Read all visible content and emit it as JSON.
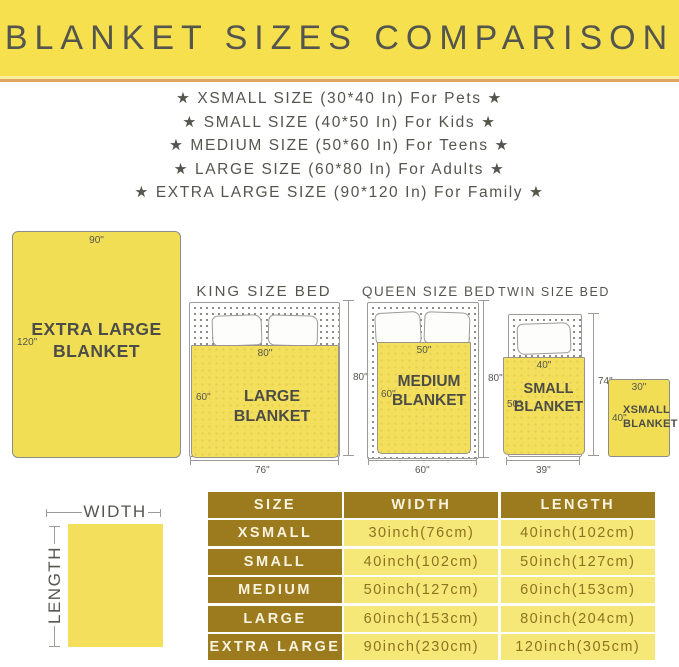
{
  "banner": {
    "title": "BLANKET SIZES COMPARISON"
  },
  "size_list": [
    "★  XSMALL SIZE (30*40 In) For Pets  ★",
    "★  SMALL SIZE (40*50 In) For Kids  ★",
    "★  MEDIUM SIZE (50*60 In) For Teens  ★",
    "★  LARGE SIZE (60*80 In) For Adults  ★",
    "★  EXTRA LARGE SIZE (90*120 In) For Family  ★"
  ],
  "diagram": {
    "xl": {
      "label_line1": "EXTRA LARGE",
      "label_line2": "BLANKET",
      "width_dim": "90\"",
      "length_dim": "120\""
    },
    "king": {
      "title": "KING SIZE BED",
      "blanket_label": "LARGE BLANKET",
      "blanket_width": "80\"",
      "blanket_length": "60\"",
      "bed_length": "80\"",
      "bed_width": "76\""
    },
    "queen": {
      "title": "QUEEN SIZE BED",
      "blanket_line1": "MEDIUM",
      "blanket_line2": "BLANKET",
      "blanket_width": "50\"",
      "blanket_length": "60\"",
      "bed_length": "80\"",
      "bed_width": "60\""
    },
    "twin": {
      "title": "TWIN SIZE BED",
      "blanket_line1": "SMALL",
      "blanket_line2": "BLANKET",
      "blanket_width": "40\"",
      "blanket_length": "50\"",
      "bed_length": "74\"",
      "bed_width": "39\""
    },
    "xsmall": {
      "label_line1": "XSMALL",
      "label_line2": "BLANKET",
      "width_dim": "30\"",
      "length_dim": "40\""
    },
    "axes": {
      "width": "WIDTH",
      "length": "LENGTH"
    }
  },
  "table": {
    "headers": [
      "SIZE",
      "WIDTH",
      "LENGTH"
    ],
    "rows": [
      {
        "size": "XSMALL",
        "width": "30inch(76cm)",
        "length": "40inch(102cm)"
      },
      {
        "size": "SMALL",
        "width": "40inch(102cm)",
        "length": "50inch(127cm)"
      },
      {
        "size": "MEDIUM",
        "width": "50inch(127cm)",
        "length": "60inch(153cm)"
      },
      {
        "size": "LARGE",
        "width": "60inch(153cm)",
        "length": "80inch(204cm)"
      },
      {
        "size": "EXTRA LARGE",
        "width": "90inch(230cm)",
        "length": "120inch(305cm)"
      }
    ]
  },
  "colors": {
    "banner_yellow": "#F6E04E",
    "accent_orange": "#E0A55E",
    "blanket_yellow": "#F2DE55",
    "table_gold": "#9C7B1E",
    "table_cell_yellow": "#F5E878",
    "text_dark": "#54554D"
  }
}
